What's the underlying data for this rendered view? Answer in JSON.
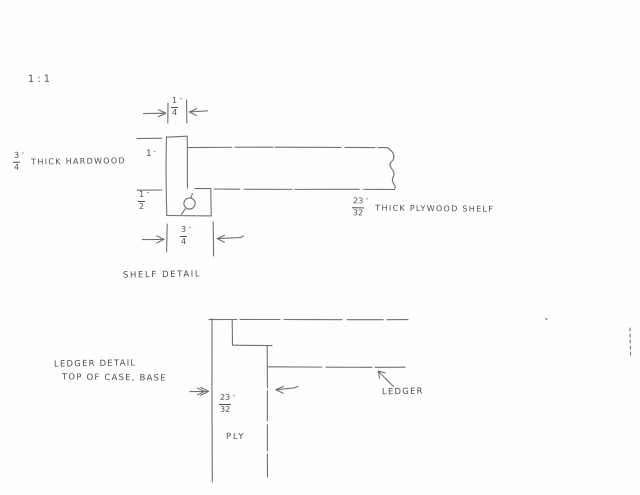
{
  "page": {
    "background_color": "#fefefe",
    "ink_color": "#707070",
    "dark_ink_color": "#3c3c3c",
    "scale_note": "1:1"
  },
  "shelf_detail": {
    "caption": "SHELF DETAIL",
    "hardwood_label": {
      "num": "3",
      "den": "4",
      "unit": "″",
      "text": "THICK HARDWOOD"
    },
    "plywood_label": {
      "num": "23",
      "den": "32",
      "unit": "″",
      "text": "THICK PLYWOOD SHELF"
    },
    "dim_edge_width_top": {
      "num": "1",
      "den": "4",
      "unit": "″"
    },
    "dim_edge_height": {
      "value": "1",
      "unit": "″"
    },
    "dim_below_ply": {
      "num": "1",
      "den": "2",
      "unit": "″"
    },
    "dim_edge_width_bottom": {
      "num": "3",
      "den": "4",
      "unit": "″"
    },
    "center_mark_symbol": "circled-q-mark"
  },
  "ledger_detail": {
    "caption_line1": "LEDGER DETAIL",
    "caption_line2": "TOP OF CASE, BASE",
    "ply_dim": {
      "num": "23",
      "den": "32",
      "unit": "″"
    },
    "ply_text": "PLY",
    "ledger_label": "LEDGER"
  }
}
